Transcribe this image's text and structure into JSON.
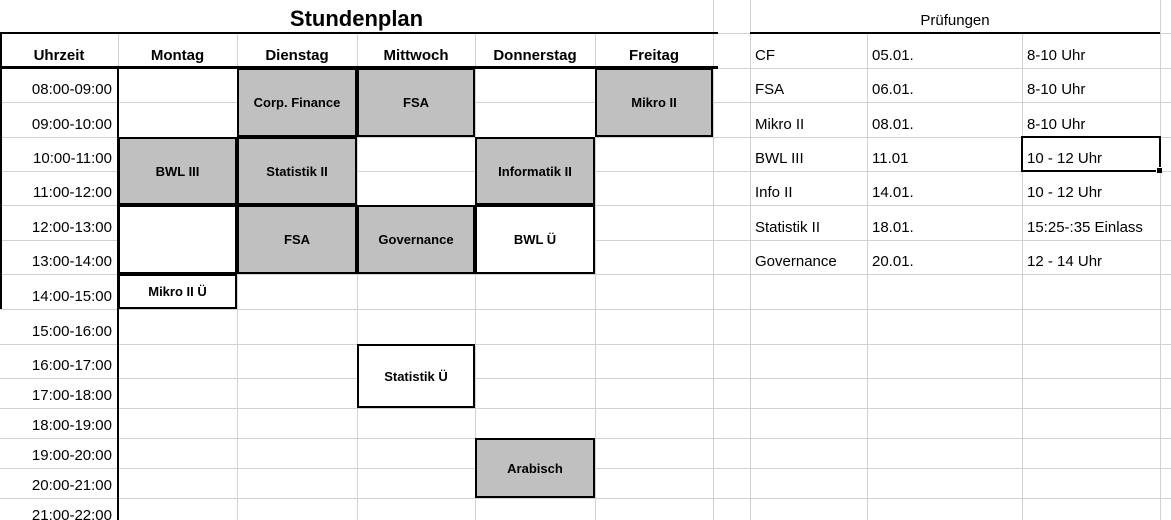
{
  "sheet": {
    "title": "Stundenplan",
    "timetable": {
      "time_header": "Uhrzeit",
      "days": [
        "Montag",
        "Dienstag",
        "Mittwoch",
        "Donnerstag",
        "Freitag"
      ],
      "time_slots": [
        "08:00-09:00",
        "09:00-10:00",
        "10:00-11:00",
        "11:00-12:00",
        "12:00-13:00",
        "13:00-14:00",
        "14:00-15:00",
        "15:00-16:00",
        "16:00-17:00",
        "17:00-18:00",
        "18:00-19:00",
        "19:00-20:00",
        "20:00-21:00",
        "21:00-22:00"
      ],
      "blocks": [
        {
          "label": "Corp. Finance",
          "day": "Dienstag",
          "start": "08:00",
          "end": "10:00",
          "style": "gray"
        },
        {
          "label": "FSA",
          "day": "Mittwoch",
          "start": "08:00",
          "end": "10:00",
          "style": "gray"
        },
        {
          "label": "Mikro II",
          "day": "Freitag",
          "start": "08:00",
          "end": "10:00",
          "style": "gray"
        },
        {
          "label": "BWL III",
          "day": "Montag",
          "start": "10:00",
          "end": "12:00",
          "style": "gray"
        },
        {
          "label": "Statistik II",
          "day": "Dienstag",
          "start": "10:00",
          "end": "12:00",
          "style": "gray"
        },
        {
          "label": "Informatik II",
          "day": "Donnerstag",
          "start": "10:00",
          "end": "12:00",
          "style": "gray"
        },
        {
          "label": "",
          "day": "Montag",
          "start": "12:00",
          "end": "14:00",
          "style": "white"
        },
        {
          "label": "FSA",
          "day": "Dienstag",
          "start": "12:00",
          "end": "14:00",
          "style": "gray"
        },
        {
          "label": "Governance",
          "day": "Mittwoch",
          "start": "12:00",
          "end": "14:00",
          "style": "gray"
        },
        {
          "label": "BWL Ü",
          "day": "Donnerstag",
          "start": "12:00",
          "end": "14:00",
          "style": "white"
        },
        {
          "label": "Mikro II Ü",
          "day": "Montag",
          "start": "14:00",
          "end": "15:00",
          "style": "white"
        },
        {
          "label": "Statistik Ü",
          "day": "Mittwoch",
          "start": "16:00",
          "end": "18:00",
          "style": "white"
        },
        {
          "label": "Arabisch",
          "day": "Donnerstag",
          "start": "19:00",
          "end": "21:00",
          "style": "gray"
        }
      ]
    },
    "exams": {
      "title": "Prüfungen",
      "rows": [
        {
          "course": "CF",
          "date": "05.01.",
          "time": "8-10 Uhr"
        },
        {
          "course": "FSA",
          "date": "06.01.",
          "time": "8-10 Uhr"
        },
        {
          "course": "Mikro II",
          "date": "08.01.",
          "time": "8-10 Uhr"
        },
        {
          "course": "BWL III",
          "date": "11.01",
          "time": "10 - 12 Uhr",
          "selected": "time"
        },
        {
          "course": "Info II",
          "date": "14.01.",
          "time": "10 - 12 Uhr"
        },
        {
          "course": "Statistik II",
          "date": "18.01.",
          "time": "15:25-:35 Einlass"
        },
        {
          "course": "Governance",
          "date": "20.01.",
          "time": "12 - 14 Uhr"
        }
      ]
    },
    "colors": {
      "block_gray": "#c0c0c0",
      "block_white": "#ffffff",
      "grid_line": "#d2d2d2",
      "border_black": "#000000"
    }
  }
}
